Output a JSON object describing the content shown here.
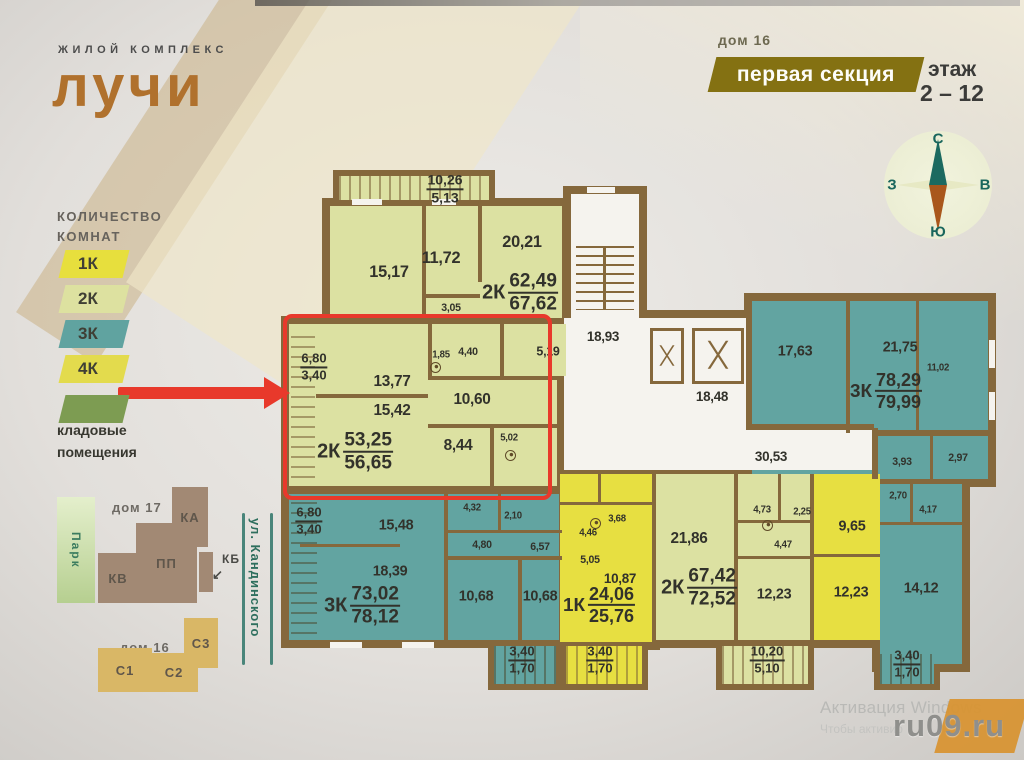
{
  "header": {
    "logo_top": "ЖИЛОЙ КОМПЛЕКС",
    "logo_main": "лучи",
    "house": "дом 16",
    "section_badge": "первая секция",
    "floor_label": "этаж",
    "floor_range": "2 – 12"
  },
  "compass": {
    "north": "С",
    "east": "В",
    "south": "Ю",
    "west": "З"
  },
  "legend": {
    "title_line1": "КОЛИЧЕСТВО",
    "title_line2": "КОМНАТ",
    "items": [
      {
        "label": "1К",
        "color": "#e7df3d"
      },
      {
        "label": "2К",
        "color": "#dde1a0"
      },
      {
        "label": "3К",
        "color": "#60a3a0"
      },
      {
        "label": "4К",
        "color": "#e3db4d"
      }
    ],
    "storage": {
      "color": "#7d9c52",
      "line1": "кладовые",
      "line2": "помещения"
    }
  },
  "sitemap": {
    "park": "Парк",
    "house17": "дом 17",
    "house16": "дом 16",
    "street": "ул. Кандинского",
    "kb_label": "КБ",
    "blocks": [
      {
        "label": "КА",
        "x": 172,
        "y": 487,
        "w": 36,
        "h": 60,
        "color": "#a28974"
      },
      {
        "label": "КВ",
        "x": 98,
        "y": 553,
        "w": 40,
        "h": 50,
        "color": "#a28974"
      },
      {
        "label": "ПП",
        "x": 136,
        "y": 523,
        "w": 61,
        "h": 80,
        "color": "#a28974"
      },
      {
        "label": "",
        "x": 199,
        "y": 552,
        "w": 14,
        "h": 40,
        "color": "#a28974"
      },
      {
        "label": "С3",
        "x": 184,
        "y": 618,
        "w": 34,
        "h": 50,
        "color": "#d9b766"
      },
      {
        "label": "С1",
        "x": 98,
        "y": 648,
        "w": 54,
        "h": 44,
        "color": "#d9b766"
      },
      {
        "label": "С2",
        "x": 150,
        "y": 653,
        "w": 48,
        "h": 39,
        "color": "#d9b766"
      }
    ]
  },
  "plan": {
    "labels": [
      {
        "t": "15,17",
        "x": 389,
        "y": 272,
        "s": 17
      },
      {
        "t": "11,72",
        "x": 441,
        "y": 258,
        "s": 17
      },
      {
        "t": "20,21",
        "x": 522,
        "y": 242,
        "s": 17
      },
      {
        "t": "3,05",
        "x": 451,
        "y": 308,
        "s": 11
      },
      {
        "t": "1,85",
        "x": 441,
        "y": 355,
        "s": 10
      },
      {
        "t": "4,40",
        "x": 468,
        "y": 352,
        "s": 11
      },
      {
        "t": "5,19",
        "x": 548,
        "y": 351,
        "s": 13
      },
      {
        "t": "13,77",
        "x": 392,
        "y": 382,
        "s": 16
      },
      {
        "t": "15,42",
        "x": 392,
        "y": 411,
        "s": 16
      },
      {
        "t": "10,60",
        "x": 472,
        "y": 400,
        "s": 16
      },
      {
        "t": "8,44",
        "x": 458,
        "y": 446,
        "s": 16
      },
      {
        "t": "5,02",
        "x": 509,
        "y": 438,
        "s": 10
      },
      {
        "t": "18,93",
        "x": 603,
        "y": 336,
        "s": 14
      },
      {
        "t": "18,48",
        "x": 712,
        "y": 396,
        "s": 14
      },
      {
        "t": "30,53",
        "x": 771,
        "y": 456,
        "s": 14
      },
      {
        "t": "17,63",
        "x": 795,
        "y": 351,
        "s": 15
      },
      {
        "t": "21,75",
        "x": 900,
        "y": 347,
        "s": 15
      },
      {
        "t": "11,02",
        "x": 938,
        "y": 368,
        "s": 10
      },
      {
        "t": "3,93",
        "x": 902,
        "y": 462,
        "s": 11
      },
      {
        "t": "2,97",
        "x": 958,
        "y": 458,
        "s": 11
      },
      {
        "t": "2,70",
        "x": 898,
        "y": 496,
        "s": 10
      },
      {
        "t": "4,17",
        "x": 928,
        "y": 510,
        "s": 10
      },
      {
        "t": "14,12",
        "x": 921,
        "y": 588,
        "s": 15
      },
      {
        "t": "15,48",
        "x": 396,
        "y": 525,
        "s": 15
      },
      {
        "t": "18,39",
        "x": 390,
        "y": 571,
        "s": 15
      },
      {
        "t": "4,32",
        "x": 472,
        "y": 508,
        "s": 10
      },
      {
        "t": "2,10",
        "x": 513,
        "y": 516,
        "s": 10
      },
      {
        "t": "4,80",
        "x": 482,
        "y": 545,
        "s": 11
      },
      {
        "t": "6,57",
        "x": 540,
        "y": 547,
        "s": 11
      },
      {
        "t": "10,68",
        "x": 476,
        "y": 596,
        "s": 15
      },
      {
        "t": "10,68",
        "x": 540,
        "y": 596,
        "s": 15
      },
      {
        "t": "3,68",
        "x": 617,
        "y": 519,
        "s": 10
      },
      {
        "t": "4,46",
        "x": 588,
        "y": 533,
        "s": 10
      },
      {
        "t": "5,05",
        "x": 590,
        "y": 560,
        "s": 11
      },
      {
        "t": "10,87",
        "x": 620,
        "y": 578,
        "s": 14
      },
      {
        "t": "21,86",
        "x": 689,
        "y": 539,
        "s": 16
      },
      {
        "t": "4,73",
        "x": 762,
        "y": 510,
        "s": 10
      },
      {
        "t": "2,25",
        "x": 802,
        "y": 512,
        "s": 10
      },
      {
        "t": "4,47",
        "x": 783,
        "y": 545,
        "s": 10
      },
      {
        "t": "12,23",
        "x": 774,
        "y": 594,
        "s": 15
      },
      {
        "t": "9,65",
        "x": 852,
        "y": 526,
        "s": 15
      },
      {
        "t": "12,23",
        "x": 851,
        "y": 592,
        "s": 15
      }
    ],
    "fracs": [
      {
        "p": "",
        "a": "10,26",
        "b": "5,13",
        "x": 445,
        "y": 189,
        "s": 9
      },
      {
        "p": "2К",
        "a": "62,49",
        "b": "67,62",
        "x": 520,
        "y": 293,
        "s": 14
      },
      {
        "p": "",
        "a": "6,80",
        "b": "3,40",
        "x": 314,
        "y": 367,
        "s": 8
      },
      {
        "p": "2К",
        "a": "53,25",
        "b": "56,65",
        "x": 355,
        "y": 452,
        "s": 14
      },
      {
        "p": "3К",
        "a": "78,29",
        "b": "79,99",
        "x": 886,
        "y": 391,
        "s": 13
      },
      {
        "p": "",
        "a": "6,80",
        "b": "3,40",
        "x": 309,
        "y": 521,
        "s": 8
      },
      {
        "p": "3К",
        "a": "73,02",
        "b": "78,12",
        "x": 362,
        "y": 606,
        "s": 14
      },
      {
        "p": "1К",
        "a": "24,06",
        "b": "25,76",
        "x": 599,
        "y": 605,
        "s": 13
      },
      {
        "p": "2К",
        "a": "67,42",
        "b": "72,52",
        "x": 699,
        "y": 588,
        "s": 14
      },
      {
        "p": "",
        "a": "3,40",
        "b": "1,70",
        "x": 522,
        "y": 660,
        "s": 8
      },
      {
        "p": "",
        "a": "3,40",
        "b": "1,70",
        "x": 600,
        "y": 660,
        "s": 8
      },
      {
        "p": "",
        "a": "10,20",
        "b": "5,10",
        "x": 767,
        "y": 660,
        "s": 8
      },
      {
        "p": "",
        "a": "3,40",
        "b": "1,70",
        "x": 907,
        "y": 664,
        "s": 8
      }
    ]
  },
  "watermark": {
    "line1": "Активация Windows",
    "line2": "Чтобы активир",
    "site": "ru09.ru"
  }
}
